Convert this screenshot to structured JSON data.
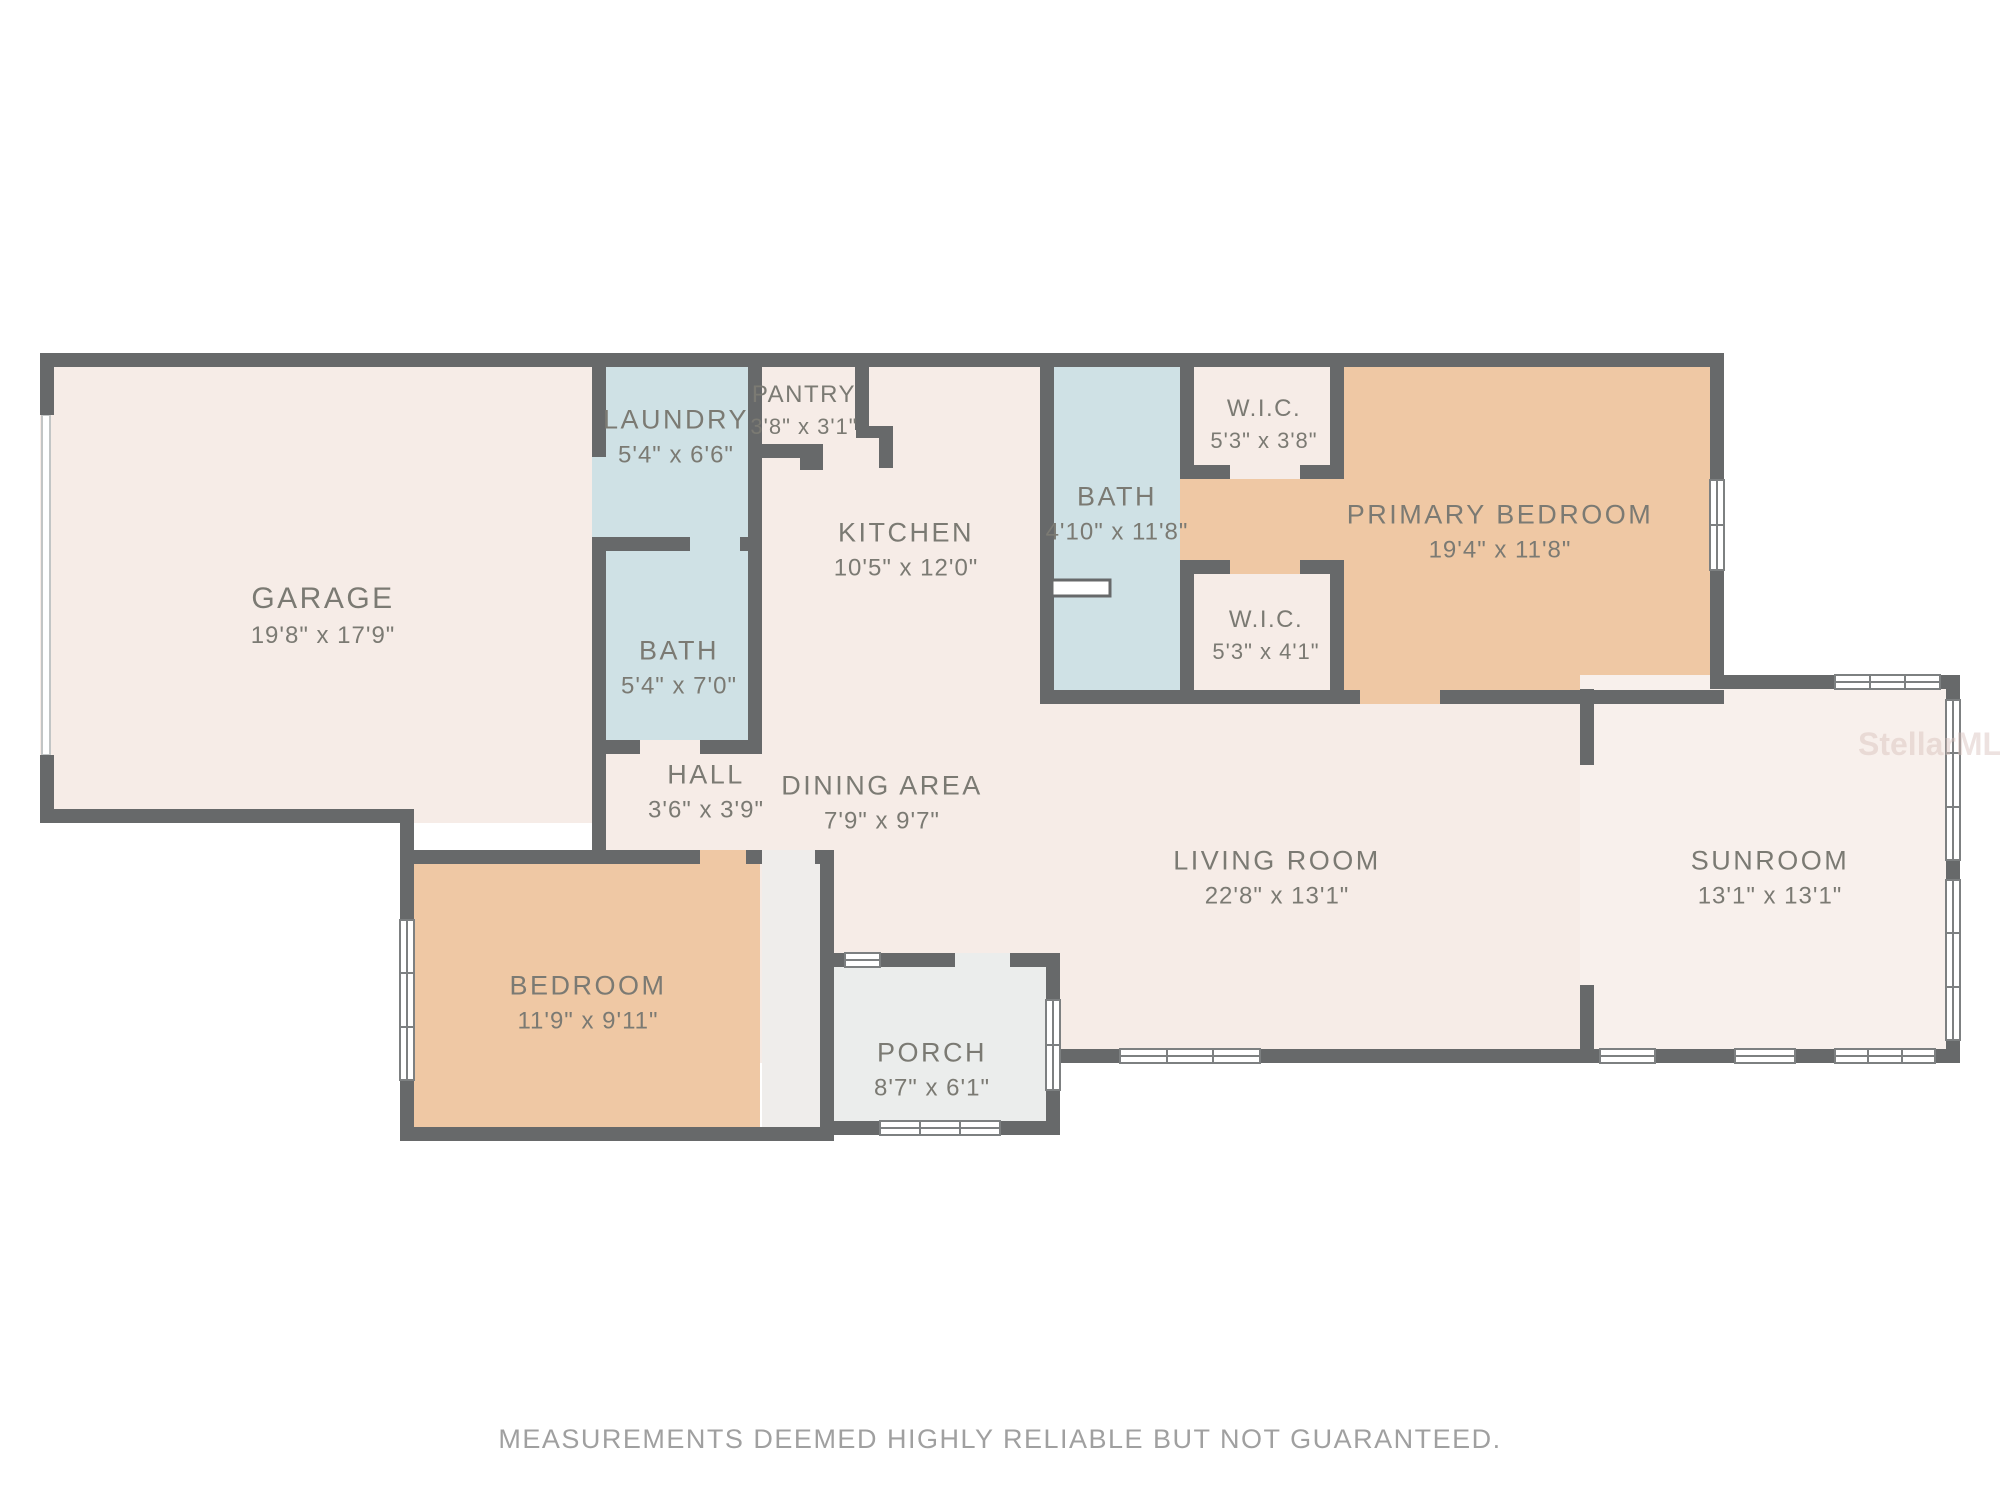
{
  "plan": {
    "disclaimer": "MEASUREMENTS DEEMED HIGHLY RELIABLE BUT NOT GUARANTEED.",
    "watermark": "StellarMLS",
    "colors": {
      "wall": "#67696a",
      "beige": "#f6ece7",
      "salmon": "#efc8a4",
      "blue": "#cfe1e5",
      "grayroom": "#ebedec",
      "closet": "#efedeb",
      "sunroomfill": "#f8f0ec",
      "roomtext": "#7b7a73",
      "disclaimer": "#a0a0a0",
      "watermark": "#d8c0bb"
    },
    "rooms": {
      "garage": {
        "name": "GARAGE",
        "dims": "19'8\" x 17'9\""
      },
      "laundry": {
        "name": "LAUNDRY",
        "dims": "5'4\" x 6'6\""
      },
      "pantry": {
        "name": "PANTRY",
        "dims": "3'8\" x 3'1\""
      },
      "kitchen": {
        "name": "KITCHEN",
        "dims": "10'5\" x 12'0\""
      },
      "bath_primary": {
        "name": "BATH",
        "dims": "4'10\" x 11'8\""
      },
      "wic_top": {
        "name": "W.I.C.",
        "dims": "5'3\" x 3'8\""
      },
      "primary_bedroom": {
        "name": "PRIMARY BEDROOM",
        "dims": "19'4\" x 11'8\""
      },
      "bath_hall": {
        "name": "BATH",
        "dims": "5'4\" x 7'0\""
      },
      "hall": {
        "name": "HALL",
        "dims": "3'6\" x 3'9\""
      },
      "dining": {
        "name": "DINING AREA",
        "dims": "7'9\" x 9'7\""
      },
      "wic_bottom": {
        "name": "W.I.C.",
        "dims": "5'3\" x 4'1\""
      },
      "living": {
        "name": "LIVING ROOM",
        "dims": "22'8\" x 13'1\""
      },
      "sunroom": {
        "name": "SUNROOM",
        "dims": "13'1\" x 13'1\""
      },
      "bedroom": {
        "name": "BEDROOM",
        "dims": "11'9\" x 9'11\""
      },
      "porch": {
        "name": "PORCH",
        "dims": "8'7\" x 6'1\""
      }
    }
  }
}
